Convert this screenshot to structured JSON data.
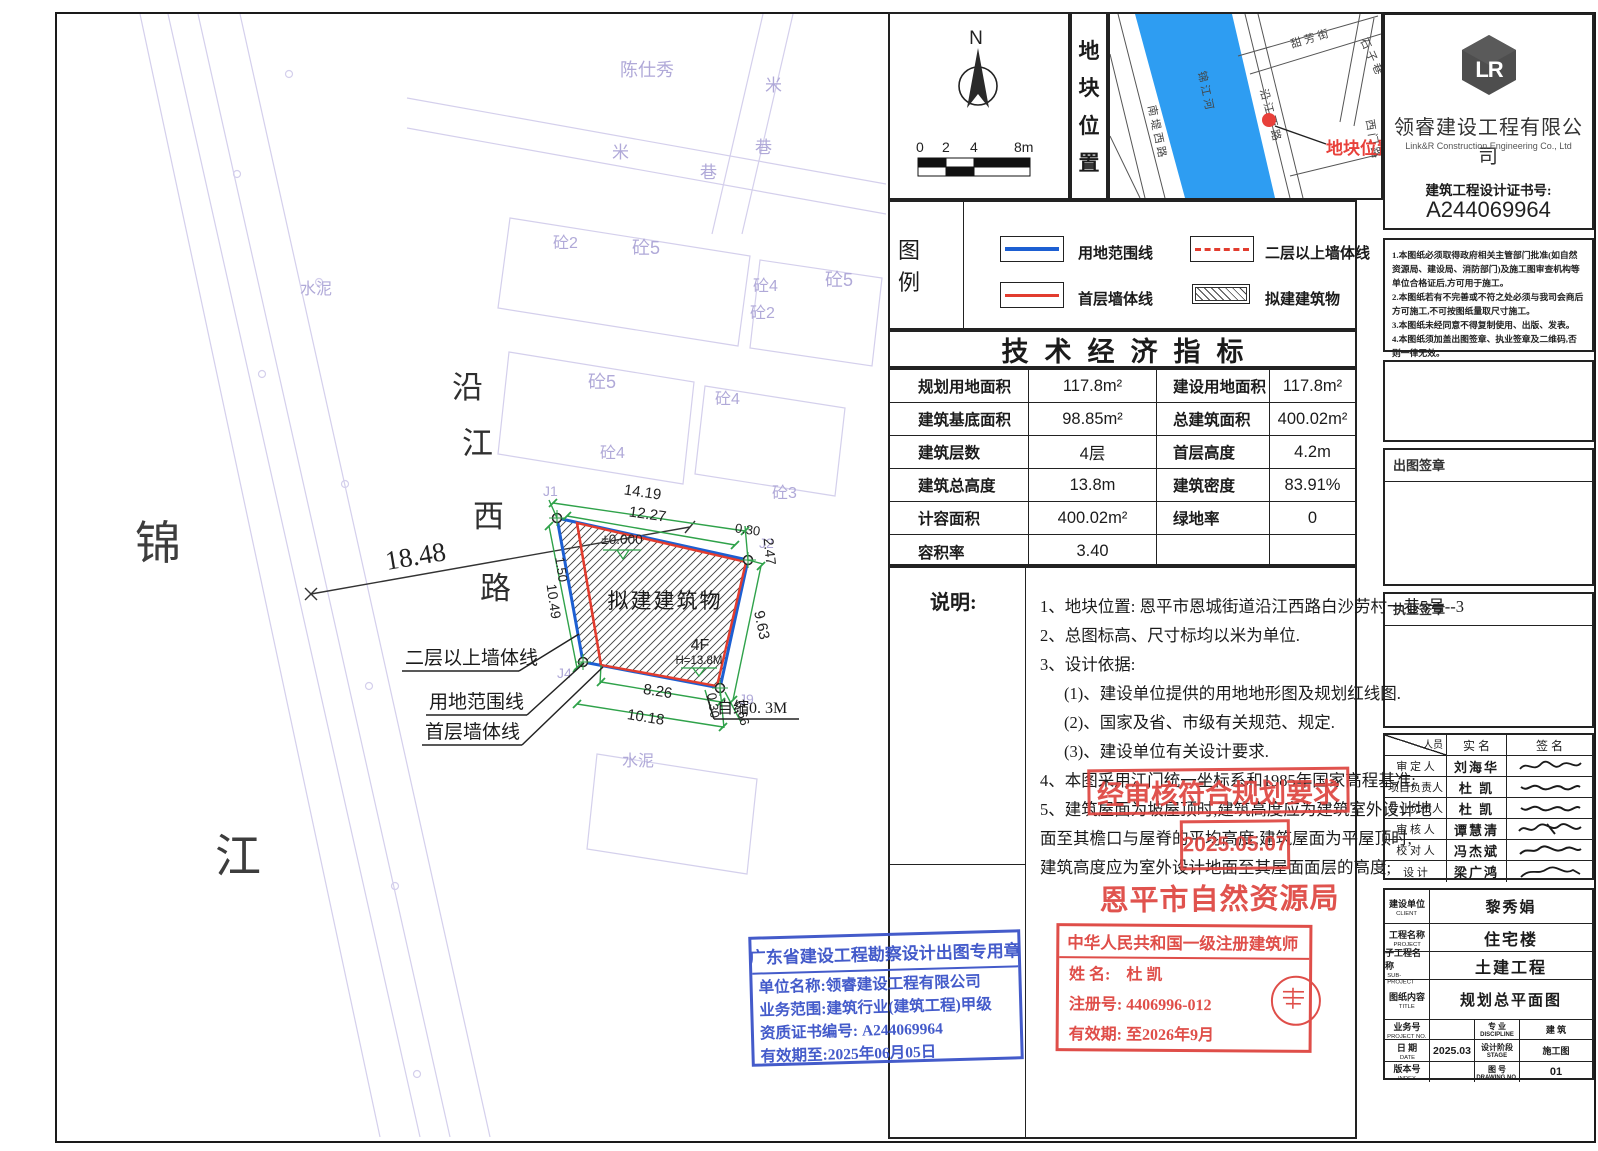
{
  "colors": {
    "boundary_blue": "#1d5fd2",
    "wall_red": "#e23c2e",
    "dim_green": "#2fa24a",
    "stamp_red": "#de4540",
    "stamp_blue": "#3a53c8",
    "river_blue": "#2e9df2",
    "faint": "#b7b1dc"
  },
  "site": {
    "river_chars": [
      "锦",
      "江"
    ],
    "road_chars": [
      "沿",
      "江",
      "西",
      "路"
    ],
    "road_width_dim": "18.48",
    "building_label": "拟建建筑物",
    "floors_label": "4F",
    "height_label": "H=13.8M",
    "elevation_label": "±0.000",
    "shrink_label": "自缩0. 3M",
    "callout_upper_wall": "二层以上墙体线",
    "callout_boundary": "用地范围线",
    "callout_first_wall": "首层墙体线",
    "dims": {
      "top_outer": "14.19",
      "top_inner": "12.27",
      "top_right_offset": "0.30",
      "right_top": "2.47",
      "right_side": "9.63",
      "left_top": "1.50",
      "left_side": "10.49",
      "bottom_inner": "8.26",
      "bottom_outer": "10.18",
      "bottom_right_offset": "0.30",
      "bottom_right_edge": "0.66"
    },
    "corner_labels": [
      "J1",
      "J2",
      "J4",
      "J9"
    ],
    "bg_labels": [
      {
        "t": "陈仕秀"
      },
      {
        "t": "米"
      },
      {
        "t": "巷"
      },
      {
        "t": "米"
      },
      {
        "t": "巷"
      },
      {
        "t": "砼2"
      },
      {
        "t": "砼5"
      },
      {
        "t": "砼4"
      },
      {
        "t": "砼2"
      },
      {
        "t": "砼5"
      },
      {
        "t": "水泥"
      },
      {
        "t": "砼5"
      },
      {
        "t": "砼4"
      },
      {
        "t": "砼3"
      },
      {
        "t": "砼4"
      },
      {
        "t": "水泥"
      }
    ]
  },
  "compass": {
    "north_label": "N",
    "scale_ticks": [
      "0",
      "2",
      "4",
      "8m"
    ]
  },
  "location_strip": {
    "chars": [
      "地",
      "块",
      "位",
      "置"
    ]
  },
  "map": {
    "river_name": "锦江河",
    "road_left": "南堤西路",
    "road_right": "沿江西路",
    "street_top": "甜芳街",
    "street_top_right": "石子巷",
    "street_right": "西门路",
    "marker_label": "地块位置"
  },
  "company": {
    "name": "领睿建设工程有限公司",
    "name_en": "Link&R Construction Engineering Co., Ltd",
    "cert_label": "建筑工程设计证书号:",
    "cert_no": "A244069964",
    "logo_letters": "LR"
  },
  "disclaimer": {
    "items": [
      "1.本图纸必须取得政府相关主管部门批准(如自然资源局、建设局、消防部门)及施工图审查机构等单位合格证后,方可用于施工。",
      "2.本图纸若有不完善或不符之处必须与我司会商后方可施工,不可按图纸量取尺寸施工。",
      "3.本图纸未经同意不得复制使用、出版、发表。",
      "4.本图纸须加盖出图签章、执业签章及二维码,否则一律无效。"
    ]
  },
  "legend": {
    "title": "图 例",
    "items": [
      {
        "label": "用地范围线"
      },
      {
        "label": "二层以上墙体线"
      },
      {
        "label": "首层墙体线"
      },
      {
        "label": "拟建建筑物"
      }
    ]
  },
  "indicators": {
    "title": "技术经济指标",
    "rows": [
      [
        "规划用地面积",
        "117.8m²",
        "建设用地面积",
        "117.8m²"
      ],
      [
        "建筑基底面积",
        "98.85m²",
        "总建筑面积",
        "400.02m²"
      ],
      [
        "建筑层数",
        "4层",
        "首层高度",
        "4.2m"
      ],
      [
        "建筑总高度",
        "13.8m",
        "建筑密度",
        "83.91%"
      ],
      [
        "计容面积",
        "400.02m²",
        "绿地率",
        "0"
      ],
      [
        "容积率",
        "3.40",
        "",
        ""
      ]
    ]
  },
  "notes": {
    "label": "说明:",
    "lines": [
      "1、地块位置: 恩平市恩城街道沿江西路白沙劳村一巷5号--3",
      "2、总图标高、尺寸标均以米为单位.",
      "3、设计依据:",
      "(1)、建设单位提供的用地地形图及规划红线图.",
      "(2)、国家及省、市级有关规范、规定.",
      "(3)、建设单位有关设计要求.",
      "4、本图采用江门统一坐标系和1985年国家高程基准;",
      "5、建筑屋面为坡屋顶时,建筑高度应为建筑室外设计地",
      "面至其檐口与屋脊的平均高度;建筑屋面为平屋顶时,",
      "建筑高度应为室外设计地面至其屋面面层的高度;"
    ]
  },
  "approval_stamp": {
    "line1": "经审核符合规划要求",
    "date": "2025.05.07",
    "org": "恩平市自然资源局"
  },
  "blue_stamp": {
    "title": "广东省建设工程勘察设计出图专用章",
    "lines": [
      "单位名称:领睿建设工程有限公司",
      "业务范围:建筑行业(建筑工程)甲级",
      "资质证书编号: A244069964",
      "有效期至:2025年06月05日"
    ]
  },
  "architect_stamp": {
    "title": "中华人民共和国一级注册建筑师",
    "name_line": "姓 名:　杜 凯",
    "reg_line": "注册号: 4406996-012",
    "valid_line": "有效期: 至2026年9月"
  },
  "sign_sections": {
    "plot_seal": "出图签章",
    "practice_seal": "执业签章"
  },
  "personnel": {
    "header_person": "人员",
    "header_name": "实  名",
    "header_sign": "签  名",
    "rows": [
      {
        "role": "审 定 人",
        "name": "刘海华"
      },
      {
        "role": "项目负责人",
        "name": "杜 凯"
      },
      {
        "role": "专业负责人",
        "name": "杜 凯"
      },
      {
        "role": "审 核 人",
        "name": "谭慧清"
      },
      {
        "role": "校 对 人",
        "name": "冯杰斌"
      },
      {
        "role": "设  计",
        "name": "梁广鸿"
      }
    ]
  },
  "title_block": {
    "client_label": "建设单位",
    "client_label_en": "CLIENT",
    "client": "黎秀娟",
    "project_label": "工程名称",
    "project_label_en": "PROJECT",
    "project": "住宅楼",
    "sub_label": "子工程名称",
    "sub_label_en": "SUB-PROJECT",
    "sub": "土建工程",
    "title_label": "图纸内容",
    "title_label_en": "TITLE",
    "title": "规划总平面图",
    "projno_label": "业务号",
    "projno_label_en": "PROJECT NO.",
    "projno": "",
    "discipline_label": "专 业",
    "discipline_label_en": "DISCIPLINE",
    "discipline": "建 筑",
    "date_label": "日 期",
    "date_label_en": "DATE",
    "date": "2025.03",
    "stage_label": "设计阶段",
    "stage_label_en": "STAGE",
    "stage": "施工图",
    "index_label": "版本号",
    "index_label_en": "INDEX",
    "index": "",
    "dwgno_label": "图 号",
    "dwgno_label_en": "DRAWING NO.",
    "dwgno": "01"
  }
}
